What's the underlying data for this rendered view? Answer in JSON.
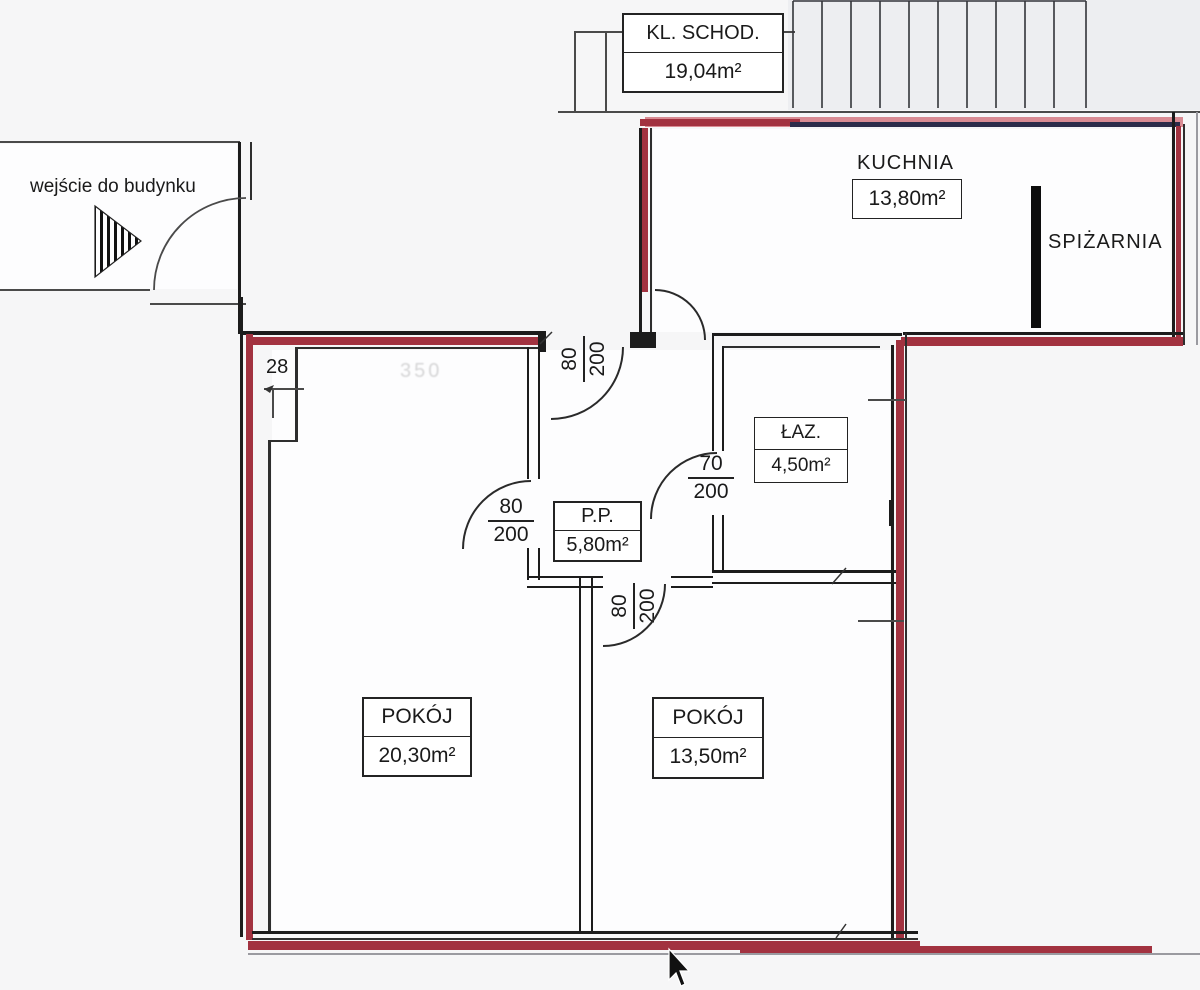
{
  "staircase": {
    "name": "KL. SCHOD.",
    "area": "19,04m²"
  },
  "kitchen": {
    "name": "KUCHNIA",
    "area": "13,80m²"
  },
  "pantry": {
    "name": "SPIŻARNIA"
  },
  "bathroom": {
    "name": "ŁAZ.",
    "area": "4,50m²"
  },
  "hall": {
    "name": "P.P.",
    "area": "5,80m²"
  },
  "room_left": {
    "name": "POKÓJ",
    "area": "20,30m²"
  },
  "room_right": {
    "name": "POKÓJ",
    "area": "13,50m²"
  },
  "annotations": {
    "building_entrance": "wejście do budynku",
    "dim_28": "28",
    "faint_dim": "350"
  },
  "doors": {
    "entrance": {
      "w": "80",
      "h": "200"
    },
    "room_left": {
      "w": "80",
      "h": "200"
    },
    "bathroom": {
      "w": "70",
      "h": "200"
    },
    "room_right": {
      "w": "80",
      "h": "200"
    }
  },
  "colors": {
    "wall_black": "#1c1c1c",
    "wall_red": "#a23240",
    "wall_pink": "#d98b93",
    "wall_navy": "#2c2c4a"
  }
}
